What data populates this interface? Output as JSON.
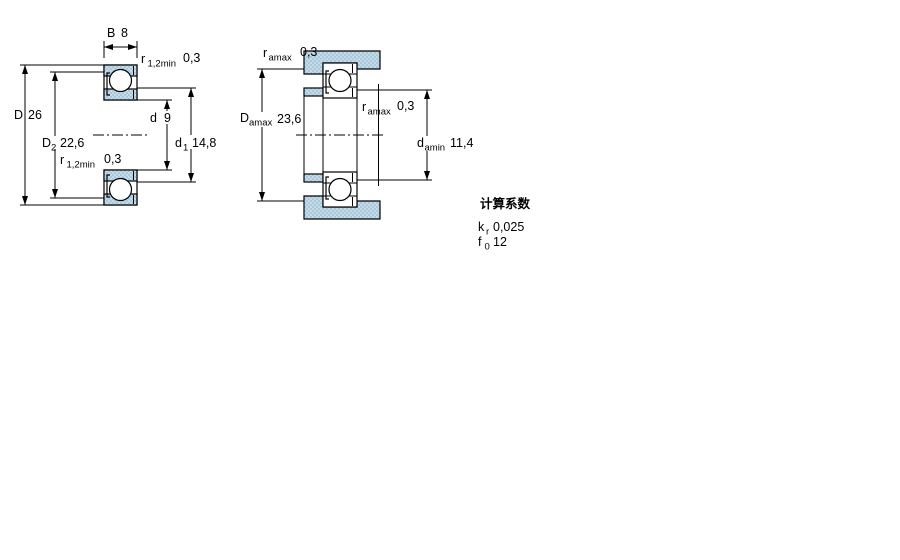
{
  "drawing": {
    "colors": {
      "hatch_base": "#a9c8dc",
      "hatch_dot": "#c6dbe8",
      "line": "#000000"
    },
    "left_view": {
      "b": {
        "base": "B",
        "value": "8"
      },
      "r12_top": {
        "base": "r",
        "sub": "1,2min",
        "value": "0,3"
      },
      "D": {
        "base": "D",
        "value": "26"
      },
      "D2": {
        "base": "D",
        "sub": "2",
        "value": "22,6"
      },
      "r12_mid": {
        "base": "r",
        "sub": "1,2min",
        "value": "0,3"
      },
      "d": {
        "base": "d",
        "value": "9"
      },
      "d1": {
        "base": "d",
        "sub": "1",
        "value": "14,8"
      }
    },
    "right_view": {
      "ra_top": {
        "base": "r",
        "sub": "amax",
        "value": "0,3"
      },
      "Da": {
        "base": "D",
        "sub": "amax",
        "value": "23,6"
      },
      "ra_mid": {
        "base": "r",
        "sub": "amax",
        "value": "0,3"
      },
      "da": {
        "base": "d",
        "sub": "amin",
        "value": "11,4"
      }
    },
    "factors": {
      "title": "计算系数",
      "kr": {
        "base": "k",
        "sub": "r",
        "value": "0,025"
      },
      "f0": {
        "base": "f",
        "sub": "0",
        "value": "12"
      }
    }
  }
}
